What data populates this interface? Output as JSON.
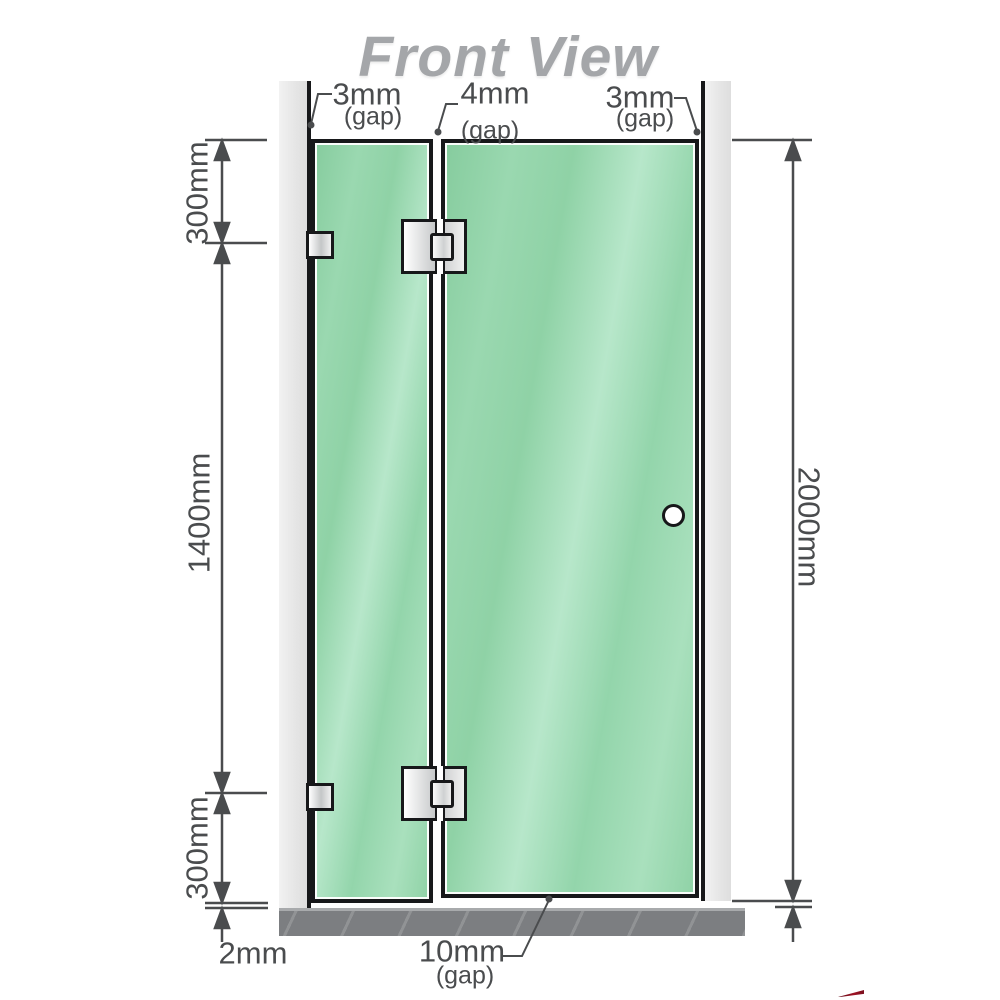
{
  "title": "Front View",
  "top_gaps": {
    "left": {
      "value": "3mm",
      "unit": "(gap)"
    },
    "middle": {
      "value": "4mm",
      "unit": "(gap)"
    },
    "right": {
      "value": "3mm",
      "unit": "(gap)"
    }
  },
  "vertical_dims": {
    "top_segment": "300mm",
    "middle_segment": "1400mm",
    "bottom_segment": "300mm",
    "overall_height": "2000mm"
  },
  "bottom_dims": {
    "floor_clearance": "2mm",
    "door_floor_gap": {
      "value": "10mm",
      "unit": "(gap)"
    }
  },
  "colors": {
    "glass_green": "#93d4aa",
    "glass_highlight": "#b7e7ca",
    "outline_black": "#17181a",
    "wall_channel_gray": "#e6e6e6",
    "floor_base_gray": "#7c7e81",
    "dimension_gray": "#4a4c4e",
    "title_gray": "#a4a6a9",
    "hardware_silver": "#c4c6c7",
    "logo_red": "#a01325"
  }
}
